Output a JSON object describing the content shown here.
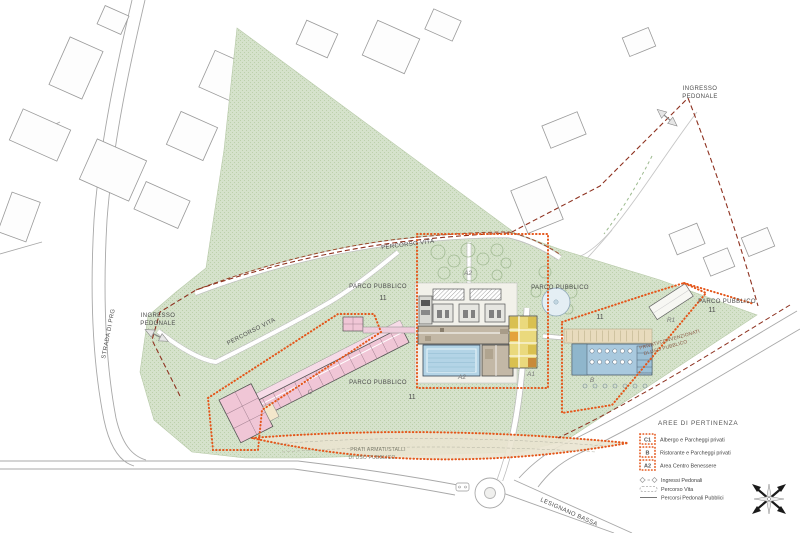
{
  "labels": {
    "parco_pubblico": "PARCO PUBBLICO",
    "parcel_number": "11",
    "ingresso_line1": "INGRESSO",
    "ingresso_line2": "PEDONALE",
    "percorso_vita": "PERCORSO VITA",
    "strada_di_prg": "STRADA DI PRG",
    "lesignano_bassa": "LESIGNANO BASSA",
    "privati_line1": "PRIVATI/CONVENZIONATI",
    "privati_line2": "DI USO PUBBLICO",
    "prati_line1": "PRATI ARMATI/STALLI",
    "prati_line2": "DI USO PUBBLICO"
  },
  "buildings": {
    "a1": "A1",
    "a2": "A2",
    "b": "B",
    "c": "C",
    "r1": "R1"
  },
  "legend": {
    "title": "AREE DI PERTINENZA",
    "areas": [
      {
        "code": "C1",
        "label": "Albergo e Parcheggi privati"
      },
      {
        "code": "B",
        "label": "Ristorante e Parcheggi privati"
      },
      {
        "code": "A2",
        "label": "Area Centro Benessere"
      }
    ],
    "lines": [
      {
        "symbol": "ingressi-pedonali-symbol",
        "label": "Ingressi Pedonali"
      },
      {
        "symbol": "percorso-vita-symbol",
        "label": "Percorso Vita"
      },
      {
        "symbol": "percorsi-pedonali-pubblici-symbol",
        "label": "Percorsi Pedonali Pubblici"
      }
    ]
  },
  "colors": {
    "park_green": "#d5e2cb",
    "park_stipple": "#bcd0ab",
    "zone_boundary_orange": "#e4561a",
    "property_boundary_red": "#8e3220",
    "hotel_pink": "#f0c6d6",
    "services_yellow": "#ead97d",
    "restaurant_blue": "#a9c9de",
    "pool_blue": "#b3d4e6",
    "parking_cream": "#eae4d0"
  }
}
